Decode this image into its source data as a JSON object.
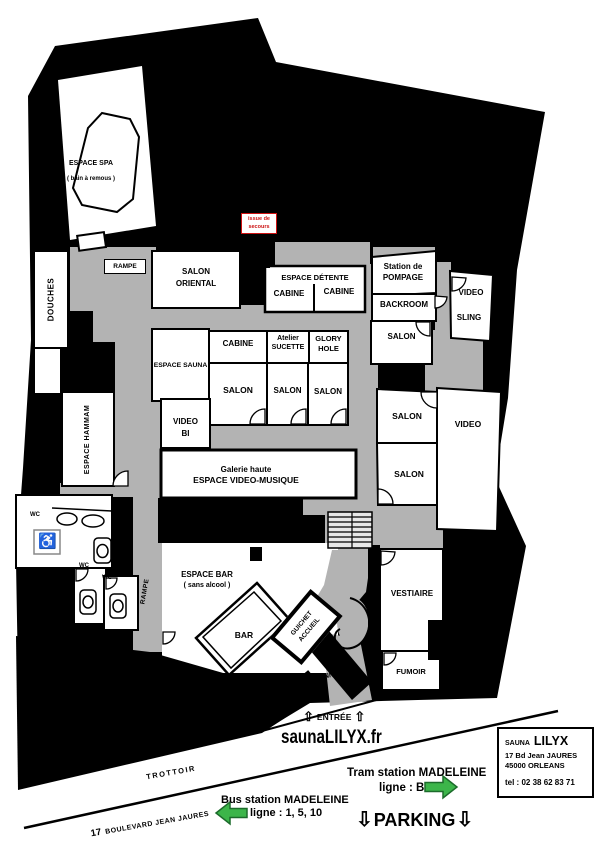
{
  "plan": {
    "espace_spa": {
      "name": "ESPACE SPA",
      "note": "( bain à remous )"
    },
    "rampe_upper": "RAMPE",
    "douches": "DOUCHES",
    "salon_oriental": "SALON ORIENTAL",
    "issue_secours": {
      "line1": "issue de",
      "line2": "secours"
    },
    "espace_detente": {
      "title": "ESPACE DÉTENTE",
      "cabine_left": "CABINE",
      "cabine_right": "CABINE"
    },
    "station_pompage": {
      "line1": "Station de",
      "line2": "POMPAGE"
    },
    "backroom": "BACKROOM",
    "video_top": "VIDEO",
    "sling": "SLING",
    "salon_backroom": "SALON",
    "cabine_center": "CABINE",
    "atelier_sucette": {
      "line1": "Atelier",
      "line2": "SUCETTE"
    },
    "glory_hole": {
      "line1": "GLORY",
      "line2": "HOLE"
    },
    "espace_sauna": "ESPACE SAUNA",
    "salon_mid_1": "SALON",
    "salon_mid_2": "SALON",
    "salon_mid_3": "SALON",
    "video_bi": {
      "line1": "VIDEO",
      "line2": "BI"
    },
    "galerie": {
      "line1": "Galerie haute",
      "line2": "ESPACE VIDEO-MUSIQUE"
    },
    "salon_right_1": "SALON",
    "salon_right_2": "SALON",
    "video_right": "VIDEO",
    "espace_hammam": "ESPACE HAMMAM",
    "wc_1": "WC",
    "wc_2": "WC",
    "wc_3": "WC",
    "rampe_lower": "RAMPE",
    "espace_bar": {
      "line1": "ESPACE BAR",
      "line2": "( sans alcool )"
    },
    "bar": "BAR",
    "guichet": "GUICHET",
    "accueil": "ACCUEIL",
    "sonnette": "SONNETTE",
    "vestiaire": "VESTIAIRE",
    "fumoir": "FUMOIR"
  },
  "exterior": {
    "entree": "ENTRÉE",
    "website": "saunaLILYX.fr",
    "tram": {
      "line1": "Tram station MADELEINE",
      "line2": "ligne : B"
    },
    "bus": {
      "line1": "Bus station MADELEINE",
      "line2": "ligne : 1, 5, 10"
    },
    "parking": "PARKING",
    "trottoir": "TROTTOIR",
    "boulevard": {
      "number": "17",
      "name": "BOULEVARD JEAN JAURES"
    },
    "info": {
      "brand_small": "SAUNA",
      "brand_large": "LILYX",
      "address_line1": "17 Bd Jean JAURES",
      "address_line2": "45000 ORLEANS",
      "phone": "tel : 02 38 62 83 71"
    }
  },
  "icons": {
    "arrow_up": "⇧",
    "arrow_down": "⇩",
    "wheelchair": "♿"
  },
  "colors": {
    "wall": "#000000",
    "corridor": "#b3b3b3",
    "room": "#ffffff",
    "green_accent": "#3cb54a",
    "red_accent": "#cc1111"
  }
}
